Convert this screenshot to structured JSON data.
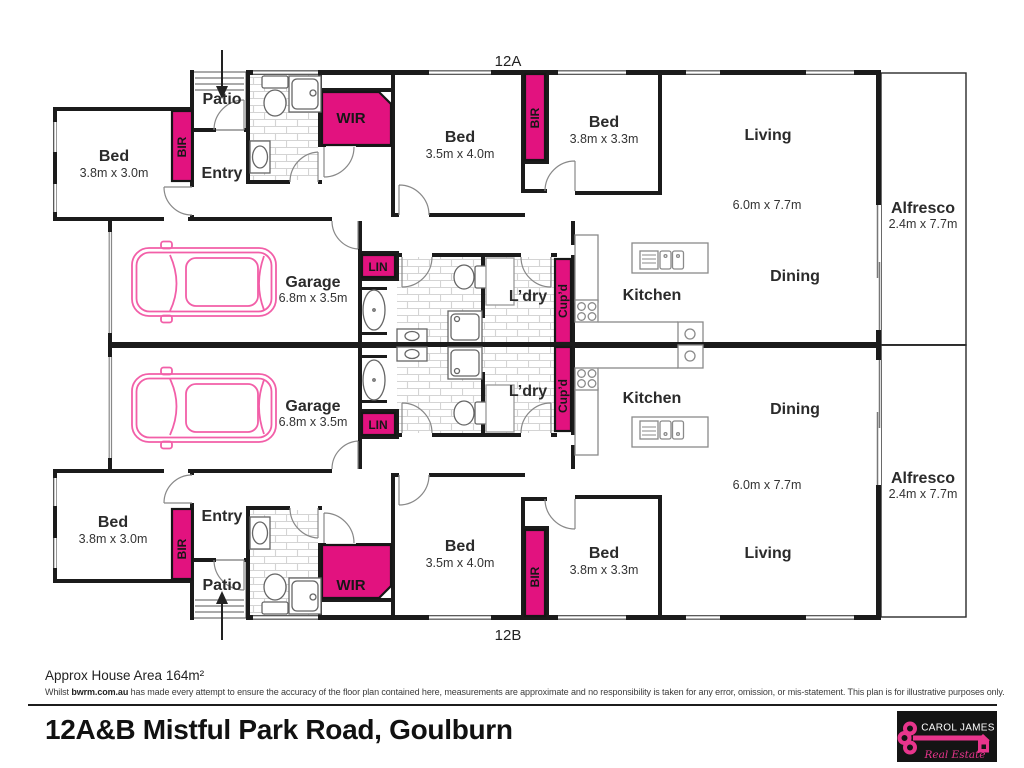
{
  "plan": {
    "unit_a_label": "12A",
    "unit_b_label": "12B",
    "rooms": {
      "bed": "Bed",
      "entry": "Entry",
      "patio": "Patio",
      "garage": "Garage",
      "kitchen": "Kitchen",
      "dining": "Dining",
      "living": "Living",
      "alfresco": "Alfresco",
      "laundry": "L’dry"
    },
    "storage": {
      "bir": "BIR",
      "wir": "WIR",
      "lin": "LIN",
      "cupd": "Cup’d"
    },
    "dims": {
      "bed_front": "3.8m x 3.0m",
      "bed_mid": "3.5m x 4.0m",
      "bed_rear": "3.8m x 3.3m",
      "garage": "6.8m x 3.5m",
      "living": "6.0m x 7.7m",
      "alfresco": "2.4m x 7.7m"
    }
  },
  "footer": {
    "area_note": "Approx House Area 164m²",
    "disclaimer_prefix": "Whilst ",
    "disclaimer_source": "bwrm.com.au",
    "disclaimer_rest": " has made every attempt to ensure the accuracy of the floor plan contained here, measurements are approximate and no responsibility is taken for any error, omission, or mis-statement. This plan is for illustrative purposes only.",
    "address": "12A&B Mistful Park Road, Goulburn"
  },
  "logo": {
    "name": "CAROL JAMES",
    "tagline": "Real Estate"
  },
  "colors": {
    "accent_magenta": "#E2127F",
    "car_outline": "#F25FA8",
    "wall": "#1b1b1b",
    "concrete_gray": "#cccccc",
    "tile_line": "#d4d4d4"
  }
}
